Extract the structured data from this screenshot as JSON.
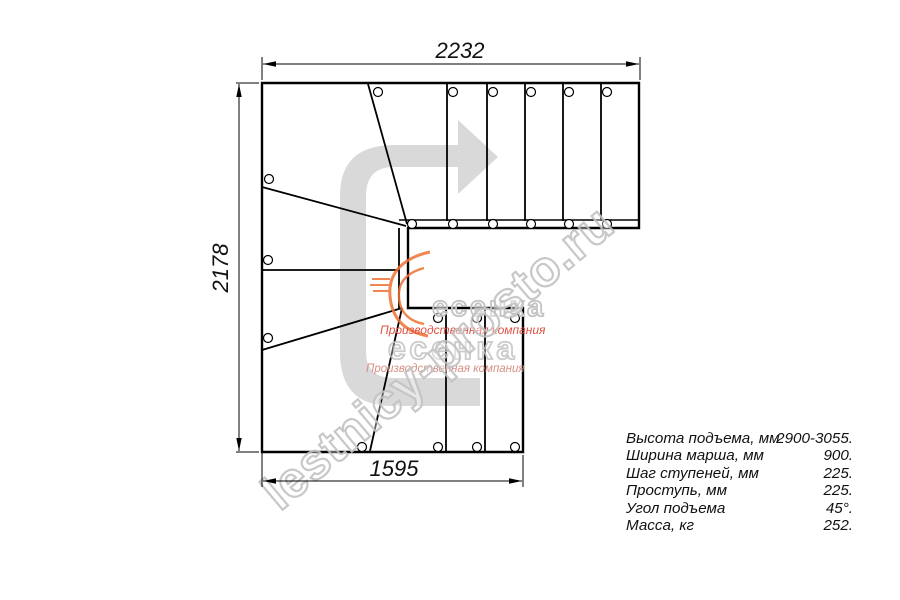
{
  "dimensions": {
    "top_width_mm": "2232",
    "left_height_mm": "2178",
    "bottom_width_mm": "1595"
  },
  "specs": {
    "rows": [
      {
        "label": "Высота подъема, мм",
        "value": "2900-3055."
      },
      {
        "label": "Ширина марша, мм",
        "value": "900."
      },
      {
        "label": "Шаг ступеней, мм",
        "value": "225."
      },
      {
        "label": "Проступь, мм",
        "value": "225."
      },
      {
        "label": "Угол подъема",
        "value": "45°."
      },
      {
        "label": "Масса, кг",
        "value": "252."
      }
    ]
  },
  "watermark": {
    "site": "lestnicy-prosto.ru",
    "brand": "есенка",
    "tagline": "Производственная компания"
  },
  "colors": {
    "line": "#000000",
    "direction_arrow": "#d9d9d9",
    "watermark_outline": "#c3c3c3",
    "tagline_red": "#df5244",
    "tagline_faded": "#d08477",
    "swoosh_orange": "#ee7135"
  }
}
